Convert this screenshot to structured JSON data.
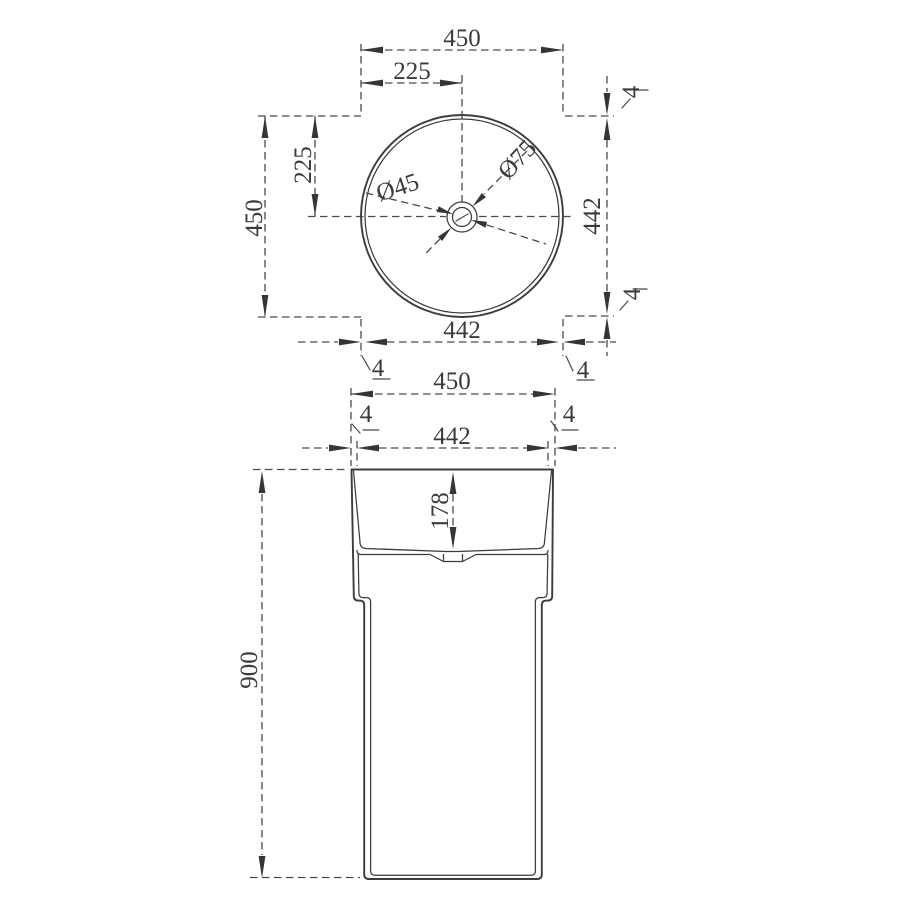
{
  "drawing": {
    "background": "#ffffff",
    "line_color": "#3c3c3c",
    "description": "pedestal wash basin technical dimension drawing, top view and front view",
    "top_view": {
      "width_total": "450",
      "width_half": "225",
      "height_total": "450",
      "height_half": "225",
      "inner_height": "442",
      "inner_width": "442",
      "rim_top": "4",
      "rim_bottom": "4",
      "rim_left": "4",
      "rim_right": "4",
      "drain_inner_diameter": "Ø45",
      "drain_outer_diameter": "Ø75"
    },
    "front_view": {
      "width_total": "450",
      "inner_width": "442",
      "rim_left": "4",
      "rim_right": "4",
      "basin_depth": "178",
      "total_height": "900"
    }
  }
}
